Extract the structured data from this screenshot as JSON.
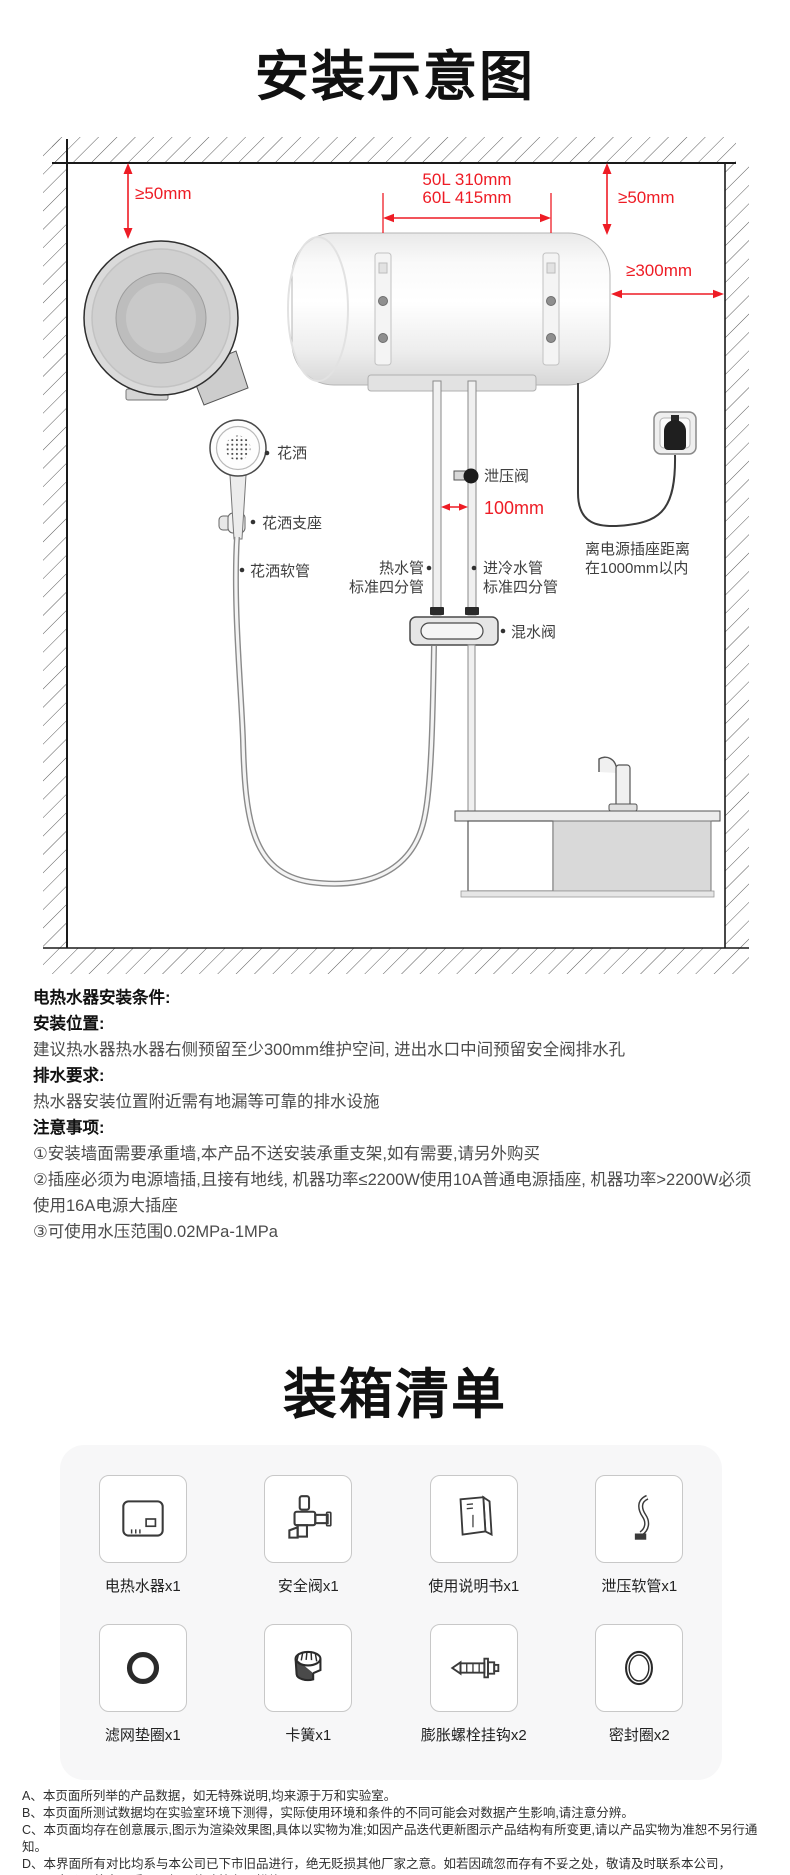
{
  "page": {
    "accent_red": "#ee1c25"
  },
  "install": {
    "title": "安装示意图",
    "dims": {
      "left_clearance": "≥50mm",
      "top_line1": "50L 310mm",
      "top_line2": "60L 415mm",
      "right_clearance": "≥50mm",
      "side_clearance": "≥300mm",
      "pipe_gap": "100mm"
    },
    "labels": {
      "shower": "花洒",
      "shower_bracket": "花洒支座",
      "shower_hose": "花洒软管",
      "relief_valve": "泄压阀",
      "hot_pipe_line1": "热水管",
      "hot_pipe_line2": "标准四分管",
      "cold_pipe_line1": "进冷水管",
      "cold_pipe_line2": "标准四分管",
      "mixing_valve": "混水阀",
      "outlet_note_line1": "离电源插座距离",
      "outlet_note_line2": "在1000mm以内"
    },
    "conditions": {
      "heading": "电热水器安装条件:",
      "loc_label": "安装位置:",
      "loc_text": "建议热水器热水器右侧预留至少300mm维护空间, 进出水口中间预留安全阀排水孔",
      "drain_label": "排水要求:",
      "drain_text": "热水器安装位置附近需有地漏等可靠的排水设施",
      "notes_label": "注意事项:",
      "note1": "①安装墙面需要承重墙,本产品不送安装承重支架,如有需要,请另外购买",
      "note2": "②插座必须为电源墙插,且接有地线, 机器功率≤2200W使用10A普通电源插座, 机器功率>2200W必须使用16A电源大插座",
      "note3": "③可使用水压范围0.02MPa-1MPa"
    }
  },
  "packing": {
    "title": "装箱清单",
    "items": [
      {
        "label": "电热水器x1",
        "icon": "water-heater-icon"
      },
      {
        "label": "安全阀x1",
        "icon": "safety-valve-icon"
      },
      {
        "label": "使用说明书x1",
        "icon": "manual-icon"
      },
      {
        "label": "泄压软管x1",
        "icon": "relief-hose-icon"
      },
      {
        "label": "滤网垫圈x1",
        "icon": "filter-gasket-icon"
      },
      {
        "label": "卡簧x1",
        "icon": "snap-ring-icon"
      },
      {
        "label": "膨胀螺栓挂钩x2",
        "icon": "expansion-bolt-icon"
      },
      {
        "label": "密封圈x2",
        "icon": "seal-ring-icon"
      }
    ]
  },
  "footnotes": [
    "A、本页面所列举的产品数据，如无特殊说明,均来源于万和实验室。",
    "B、本页面所测试数据均在实验室环境下测得，实际使用环境和条件的不同可能会对数据产生影响,请注意分辨。",
    "C、本页面均存在创意展示,图示为渲染效果图,具体以实物为准;如因产品迭代更新图示产品结构有所变更,请以产品实物为准恕不另行通知。",
    "D、本界面所有对比均系与本公司已下市旧品进行，绝无贬损其他厂家之意。如若因疏忽而存有不妥之处，敬请及时联系本公司，",
    "本公司将立即采取下架及修改等必要措施。"
  ]
}
